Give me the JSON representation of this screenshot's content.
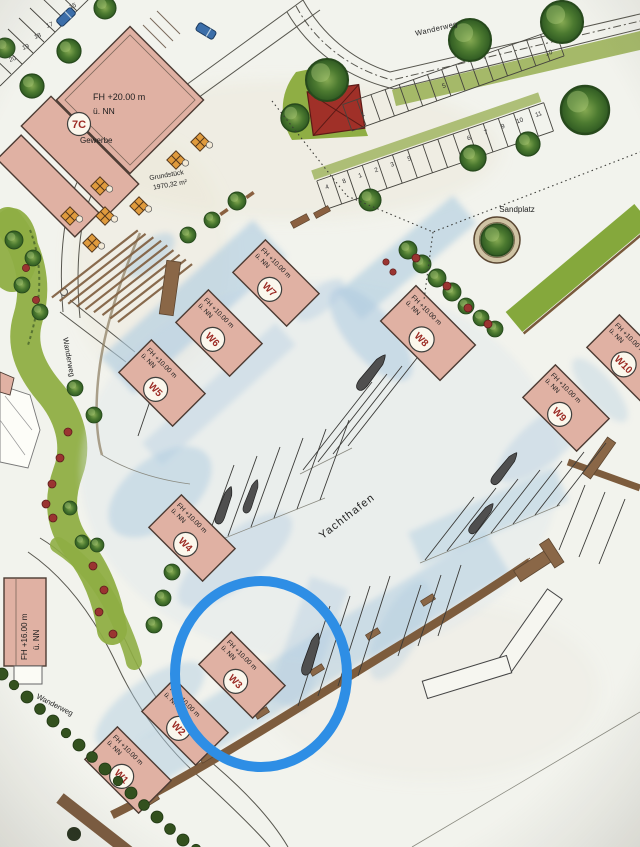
{
  "map": {
    "type": "site-plan",
    "area_labels": {
      "yachthafen": "Yachthafen",
      "sandplatz": "Sandplatz",
      "wanderweg": "Wanderweg",
      "gewerbe": "Gewerbe",
      "grundstueck_name": "Grundstück",
      "grundstueck_area": "1970,32 m²"
    },
    "height_labels": {
      "fh20": "FH +20.00 m",
      "fh16": "FH +16.00 m",
      "fh10": "FH +10.00 m",
      "nn": "ü. NN"
    },
    "buildings": {
      "b7c": {
        "id": "7C",
        "height": "FH +20.00 m",
        "datum": "ü. NN",
        "use": "Gewerbe"
      },
      "left": {
        "height": "FH +16.00 m",
        "datum": "ü. NN"
      },
      "w1": {
        "id": "W1",
        "height": "FH +10.00 m",
        "datum": "ü. NN"
      },
      "w2": {
        "id": "W2",
        "height": "FH +10.00 m",
        "datum": "ü. NN"
      },
      "w3": {
        "id": "W3",
        "height": "FH +10.00 m",
        "datum": "ü. NN"
      },
      "w4": {
        "id": "W4",
        "height": "FH +10.00 m",
        "datum": "ü. NN"
      },
      "w5": {
        "id": "W5",
        "height": "FH +10.00 m",
        "datum": "ü. NN"
      },
      "w6": {
        "id": "W6",
        "height": "FH +10.00 m",
        "datum": "ü. NN"
      },
      "w7": {
        "id": "W7",
        "height": "FH +10.00 m",
        "datum": "ü. NN"
      },
      "w8": {
        "id": "W8",
        "height": "FH +10.00 m",
        "datum": "ü. NN"
      },
      "w9": {
        "id": "W9",
        "height": "FH +10.00 m",
        "datum": "ü. NN"
      },
      "w10": {
        "id": "W10",
        "height": "FH +10.00 m",
        "datum": "ü. NN"
      }
    },
    "parking": {
      "row_nw": [
        "15",
        "17",
        "18",
        "19",
        "20"
      ],
      "row_upper": [
        "1",
        "5",
        "10"
      ],
      "row_lower": [
        "4",
        "8",
        "1",
        "2",
        "3",
        "5",
        "6",
        "7",
        "9",
        "10",
        "11"
      ]
    },
    "annotations": {
      "highlight_color": "#2e8ee5",
      "highlighted_building": "W3"
    },
    "colors": {
      "building_pink": "#e0b1a3",
      "water_blue": "#aecbe0",
      "greenery": "#8fae44",
      "pier_brown": "#7d5c3d",
      "red_area": "#a03028"
    }
  }
}
